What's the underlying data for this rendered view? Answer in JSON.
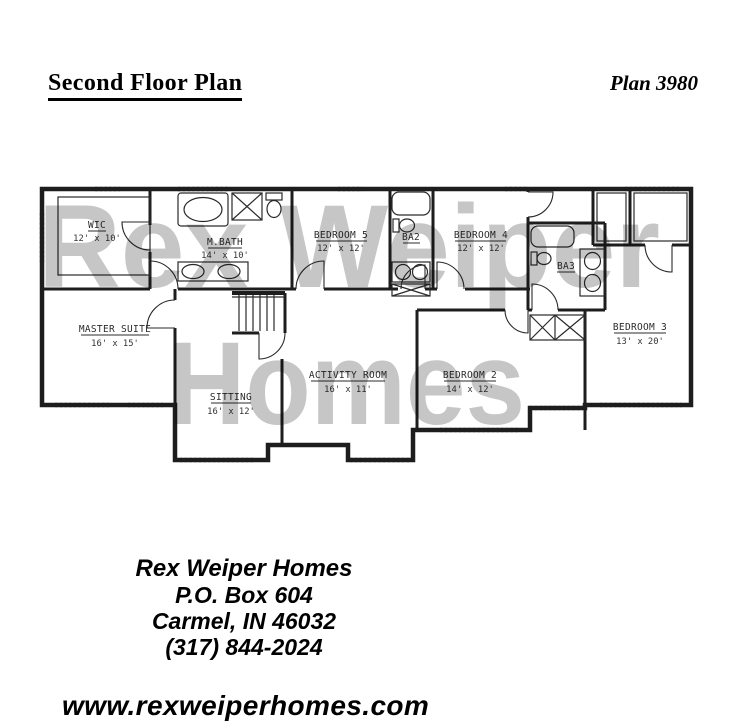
{
  "header": {
    "title": "Second Floor Plan",
    "plan_number": "Plan 3980"
  },
  "watermark": {
    "line1": "Rex Weiper",
    "line2": "Homes",
    "color": "#c6c6c6"
  },
  "plan": {
    "rooms": [
      {
        "name": "WIC",
        "dims": "12' x 10'"
      },
      {
        "name": "M.BATH",
        "dims": "14' x 10'"
      },
      {
        "name": "BEDROOM 5",
        "dims": "12' x 12'"
      },
      {
        "name": "BA2"
      },
      {
        "name": "BEDROOM 4",
        "dims": "12' x 12'"
      },
      {
        "name": "BA3"
      },
      {
        "name": "BEDROOM 3",
        "dims": "13' x 20'"
      },
      {
        "name": "MASTER SUITE",
        "dims": "16' x 15'"
      },
      {
        "name": "SITTING",
        "dims": "16' x 12'"
      },
      {
        "name": "ACTIVITY ROOM",
        "dims": "16' x 11'"
      },
      {
        "name": "BEDROOM 2",
        "dims": "14' x 12'"
      }
    ]
  },
  "footer": {
    "company": "Rex Weiper Homes",
    "po_box": "P.O. Box 604",
    "city_line": "Carmel, IN  46032",
    "phone": "(317) 844-2024",
    "website": "www.rexweiperhomes.com"
  }
}
